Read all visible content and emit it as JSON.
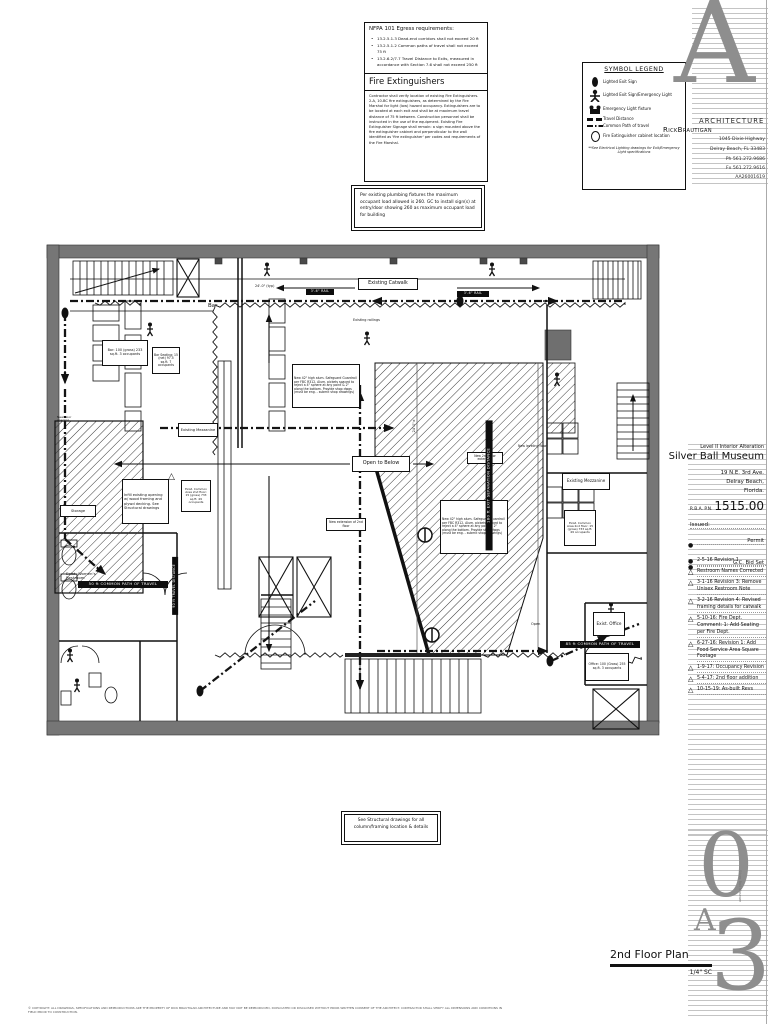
{
  "notes": {
    "nfpa": {
      "title": "NFPA 101 Egress requirements:",
      "items": [
        "13.2.5.1.3 Dead-end corridors shall not exceed 20 ft",
        "13.2.5.1.2 Common paths of travel shall not exceed 75 ft",
        "13.2.6.2/7.7 Travel Distance to Exits, measured in accordance with Section 7.6 shall not exceed 250 ft"
      ]
    },
    "fire": {
      "title": "Fire Extinguishers",
      "body": "Contractor shall verify location of existing Fire Extinguishers. 2-A, 10-BC fire extinguishers, as determined by the Fire Marshal for light (low) hazard occupancy. Extinguishers are to be located at each exit and shall be at maximum travel distance of 75 ft between. Construction personnel shall be instructed in the use of the equipment. Existing Fire Extinguisher Signage shall remain: a sign mounted above the fire extinguisher cabinet and perpendicular to the wall identified as 'fire extinguisher' per codes and requirements of the Fire Marshal."
    },
    "plumbing": "Per existing plumbing fixtures the maximum occupant load allowed is 260. GC to install sign(s) at entry/door showing 260 as maximum occupant load for building",
    "structural": "See Structural drawings for all column/framing location & details"
  },
  "legend": {
    "title": "SYMBOL LEGEND",
    "rows": [
      {
        "icon": "exit-sign",
        "label": "Lighted Exit Sign"
      },
      {
        "icon": "exit-sign-emergency-light",
        "label": "Lighted Exit Sign/Emergency Light"
      },
      {
        "icon": "emergency-light-fixture",
        "label": "Emergency Light fixture"
      },
      {
        "icon": "travel-distance-line",
        "label": "Travel Distance"
      },
      {
        "icon": "common-path-line",
        "label": "Common Path of travel"
      },
      {
        "icon": "fire-extinguisher-cabinet",
        "label": "Fire Extinguisher cabinet location"
      }
    ],
    "footnote": "**See Electrical Lighting drawings for Exit/Emergency Light specifications"
  },
  "firm": {
    "name_left": "RickBrautigan",
    "name_right": "ARCHITECTURE",
    "address1": "1045 Dixie Highway",
    "address2": "Delray Beach, FL 33483",
    "phone": "Ph 561.272.9686",
    "fax": "Fx 561.272.9616",
    "license": "AA26001619"
  },
  "project": {
    "scope": "Level II Interior Alteration",
    "name": "Silver Ball Museum",
    "addr1": "19 N.E. 3rd Ave.",
    "addr2": "Delray Beach,",
    "addr3": "Florida.",
    "pn_label": "R.B.A. P.N.",
    "pn": "1515.00",
    "issued_label": "Issued:",
    "issued": [
      {
        "text": "Permit"
      },
      {
        "text": "G.C. Bid Set"
      }
    ],
    "revisions": [
      {
        "marker": "dot",
        "text": "2-5-16 Revision 1"
      },
      {
        "marker": "tri",
        "text": "Restroom Names Corrected"
      },
      {
        "marker": "tri",
        "text": "3-1-16 Revision 3: Remove Unisex Restroom Note"
      },
      {
        "marker": "tri",
        "text": "3-2-16 Revision 4: Revised framing details for catwalk"
      },
      {
        "marker": "tri",
        "text": "5-10-16: Fire Dept. Comment: 1: Add Seating per Fire Dept."
      },
      {
        "marker": "tri",
        "text": "6-27-16: Revision 1: Add Food Service Area Square Footage"
      },
      {
        "marker": "tri",
        "text": "1-9-17: Occupancy Revision"
      },
      {
        "marker": "tri",
        "text": "5-4-17: 2nd floor addition"
      },
      {
        "marker": "tri",
        "text": "10-15-19: As-built Revs"
      }
    ]
  },
  "sheet": {
    "title": "2nd Floor Plan",
    "scale": "1/4\" SC",
    "big_zero": "0",
    "big_a": "A",
    "big_three": "3"
  },
  "plan": {
    "bar_room": "Bar",
    "bar_area": "Bar: 100 (gross) 233 sq.ft. 3 occupants",
    "bar_seating": "Bar Seating: 15 (net) 97.5 sq.ft. 7 occupants",
    "catwalk": "Existing Catwalk",
    "railings": "Existing railings",
    "open_below": "Open to Below",
    "mezzanine": "Existing Mezzanine",
    "guardrail": "New 42\" high alum. Safeguard Guardrail per FBC R312. Alum. pickets spaced to reject a 4\" sphere at any point & 2\" along the bottom. Provide shop dwgs (must be eng. - submit shop drawings)",
    "infill": "Infill existing opening w/ wood framing and plywd decking. See Structural drawings",
    "common_area": "Exist. Common Area 2nd floor: 15 (gross) 733 sq.ft. 49 occupants",
    "ext1": "New 2nd floor extension",
    "ext2": "New extension of 2nd floor",
    "leveling": "New leveling floor",
    "womens": "Exist. Women's Restroom",
    "office": "Exist. Office",
    "office_area": "Office: 100 (Gross) 255 sq.ft. 3 occupants",
    "storage": "Storage",
    "new_door": "New door opening",
    "open_stair": "Open",
    "rail": "3'-6\" RAIL",
    "t50": "50 ft COMMON PATH OF TRAVEL",
    "t85": "85 ft COMMON PATH OF TRAVEL",
    "t90": "90 ft TRAVEL DISTANCE",
    "sep180": "180 ft EXIT SEPARATION DISTANCE",
    "dim1": "24'-0\" (typ)",
    "dim2": "24'-0\"±"
  },
  "footer": {
    "copyright": "© COPYRIGHT: ALL DRAWINGS, SPECIFICATIONS AND REPRODUCTIONS ARE THE PROPERTY OF RICK BRAUTIGAN ARCHITECTURE AND MAY NOT BE REPRODUCED, DUPLICATED OR DISCLOSED WITHOUT PRIOR WRITTEN CONSENT OF THE ARCHITECT. CONTRACTOR SHALL VERIFY ALL DIMENSIONS AND CONDITIONS IN FIELD PRIOR TO CONSTRUCTION."
  }
}
